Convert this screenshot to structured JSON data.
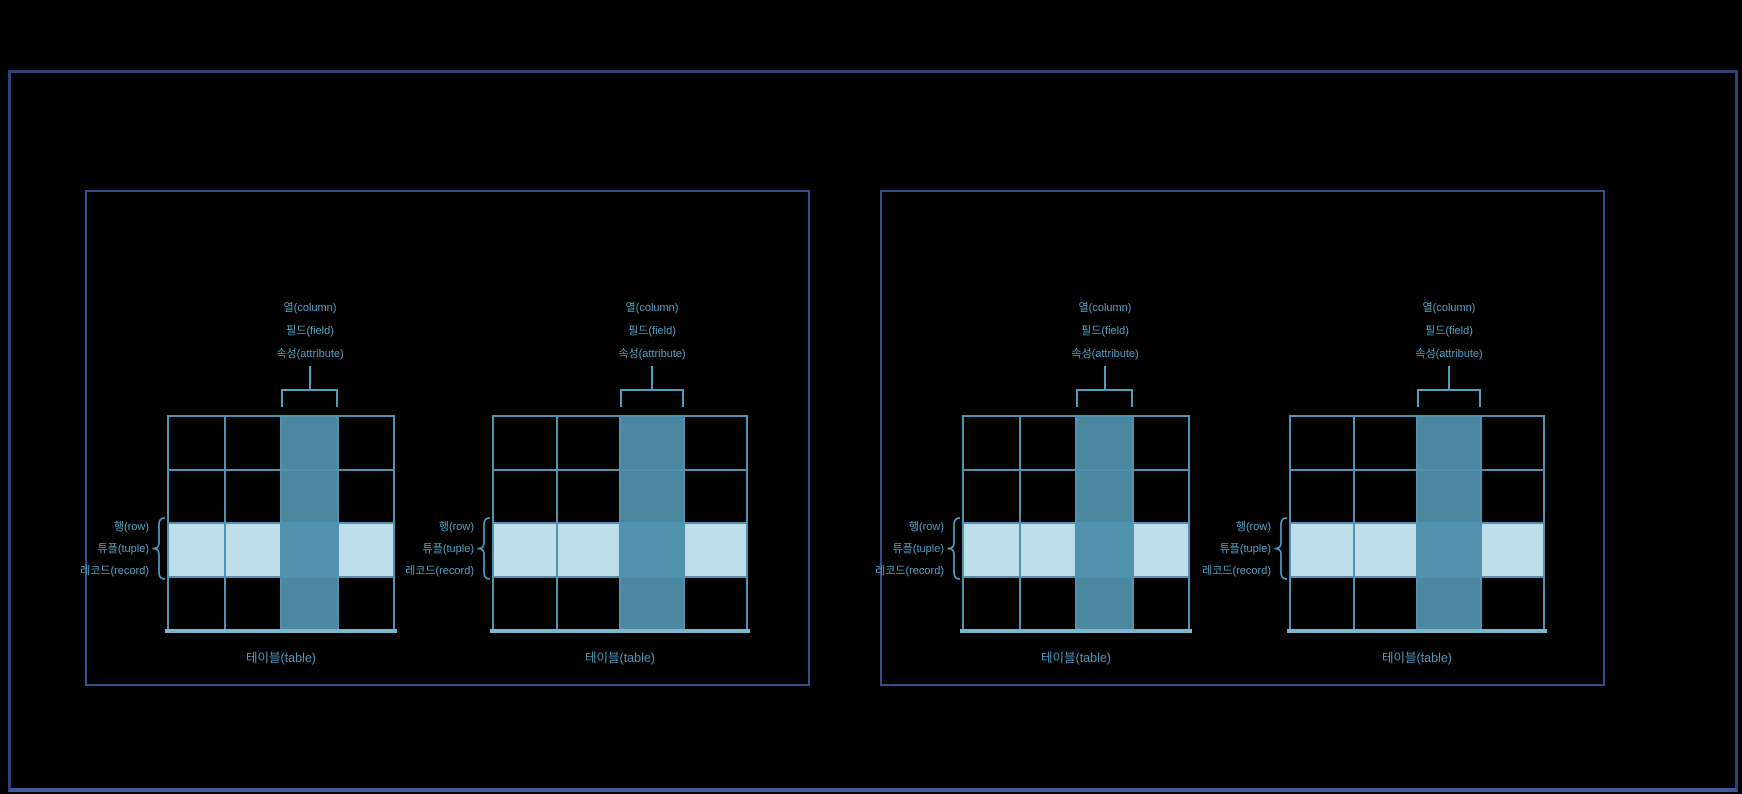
{
  "canvas": {
    "width": 1742,
    "height": 794,
    "background": "#000000"
  },
  "outer_frame": {
    "border_color": "#2c4373",
    "bottom_border_color": "#3f5aa5"
  },
  "panels": [
    {
      "name": "left-panel",
      "diagram_count": 2
    },
    {
      "name": "right-panel",
      "diagram_count": 2
    }
  ],
  "diagram_labels": {
    "column": [
      "열(column)",
      "필드(field)",
      "속성(attribute)"
    ],
    "row": [
      "행(row)",
      "튜플(tuple)",
      "레코드(record)"
    ],
    "table": "테이블(table)"
  },
  "grid": {
    "rows": 4,
    "cols": 4,
    "highlighted_column_index": 3,
    "highlighted_row_index": 3
  },
  "colors": {
    "grid_line": "#5191b2",
    "highlight_column_fill": "#4c87a0",
    "highlight_row_fill": "#bedfea",
    "intersection_fill": "#5292ad",
    "base_line": "#7cb8cd",
    "annotation": "#4f9ec0",
    "annotation_text": "#54a0c2",
    "caption_text": "#4e96ba",
    "panel_border": "#33508e"
  }
}
